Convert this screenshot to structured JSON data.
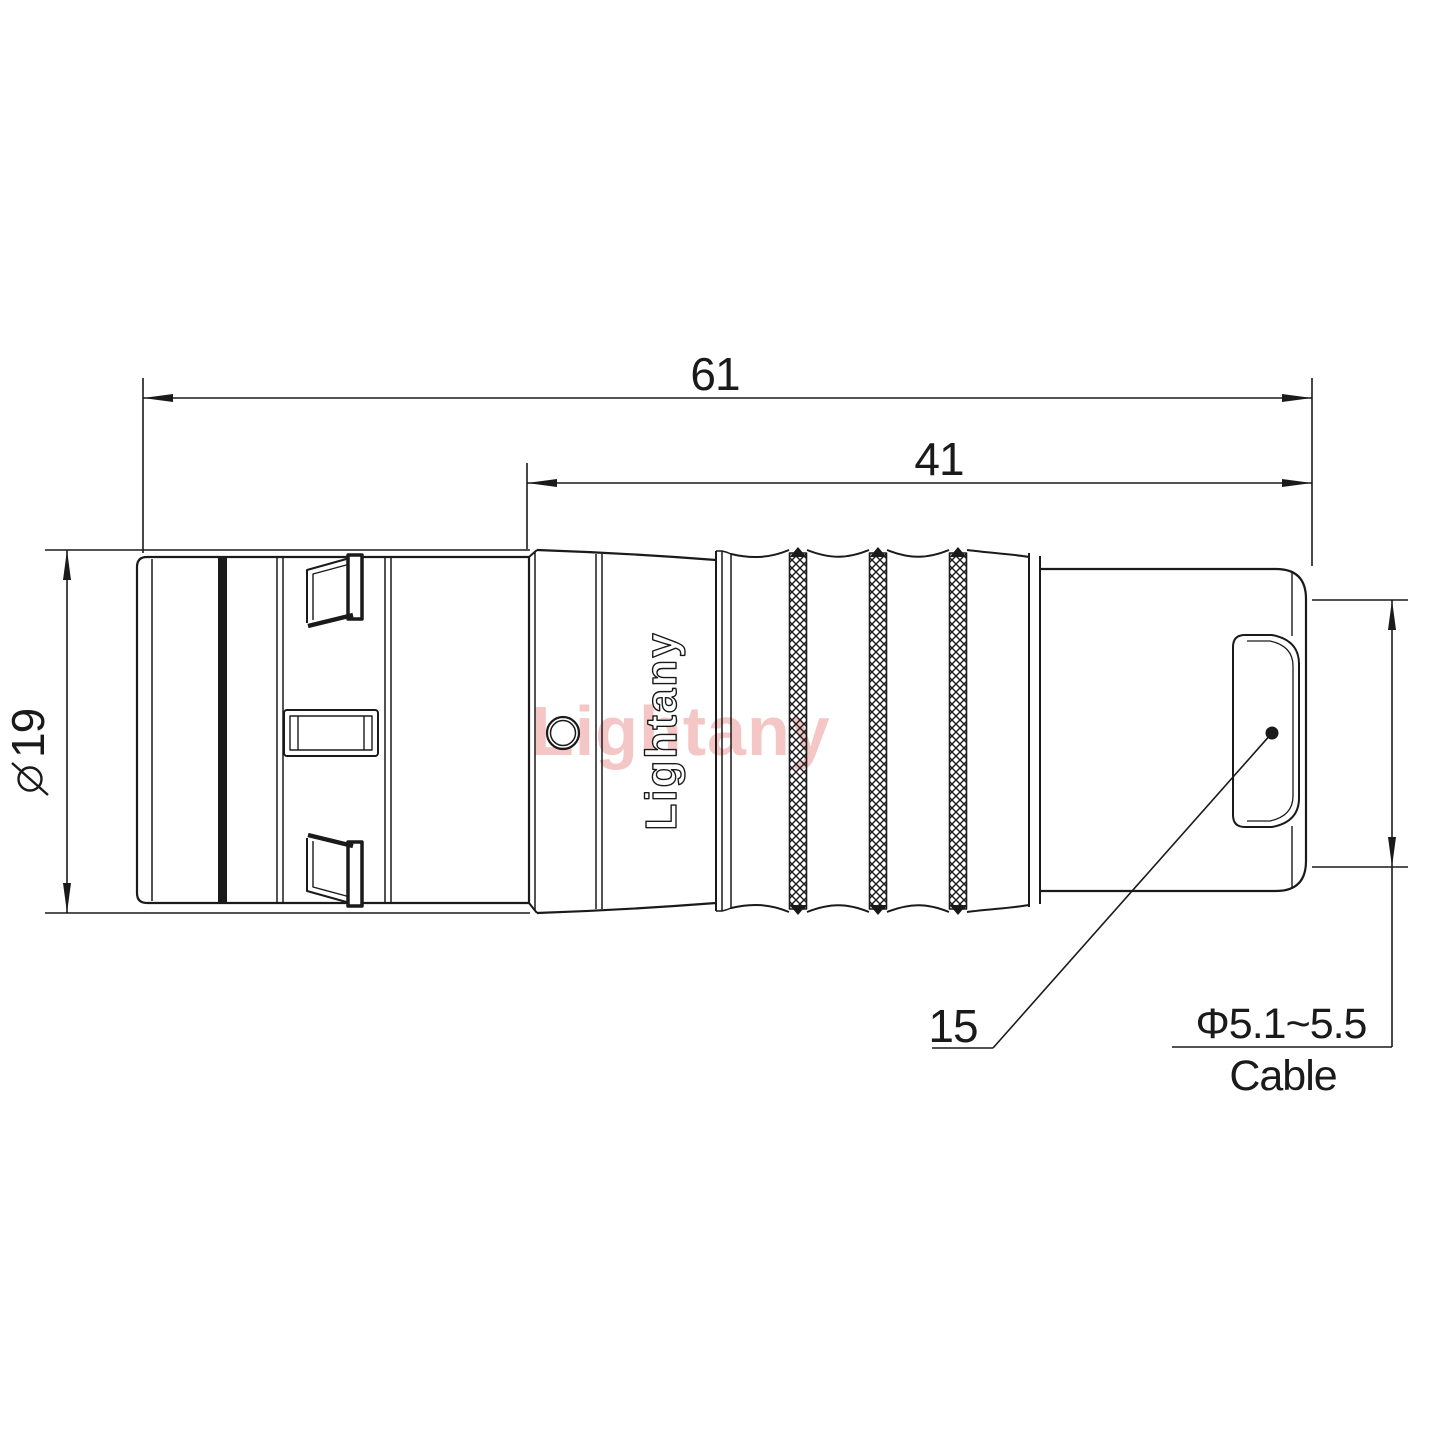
{
  "watermark": "Lightany",
  "brand_engraving": "Lightany",
  "dimensions": {
    "overall_length": "61",
    "barrel_length": "41",
    "shell_diameter": "19",
    "shell_size": "15",
    "cable_diameter": "Φ5.1~5.5",
    "cable_word": "Cable"
  },
  "colors": {
    "line": "#1a1a1a",
    "watermark": "#f5c6c6",
    "background": "#ffffff"
  }
}
